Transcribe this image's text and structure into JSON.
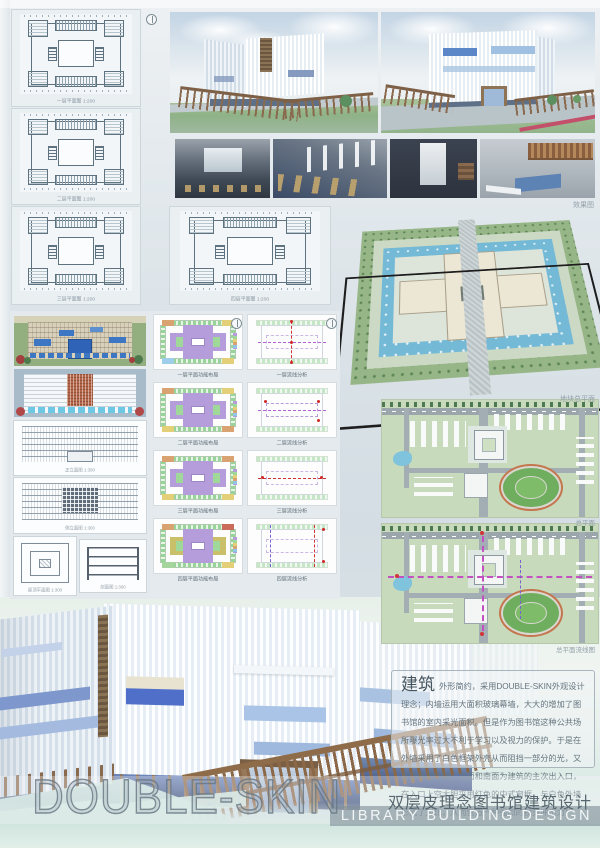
{
  "blueprints": {
    "items": [
      {
        "label": "一层平面图 1:200"
      },
      {
        "label": "二层平面图 1:200"
      },
      {
        "label": "三层平面图 1:200"
      },
      {
        "label": "四层平面图 1:200"
      }
    ]
  },
  "renders": {
    "caption": "效果图"
  },
  "site_perspective": {
    "caption": "地块总平面"
  },
  "elevations": {
    "captions": [
      "正立面图 1:300",
      "侧立面图 1:300",
      "屋顶平面图 1:300",
      "剖面图 1:300"
    ]
  },
  "plan_grid": {
    "cells": [
      {
        "label": "一层平面功能布局"
      },
      {
        "label": "一层流线分析"
      },
      {
        "label": "二层平面功能布局"
      },
      {
        "label": "二层流线分析"
      },
      {
        "label": "三层平面功能布局"
      },
      {
        "label": "三层流线分析"
      },
      {
        "label": "四层平面功能布局"
      },
      {
        "label": "四层流线分析"
      }
    ]
  },
  "site_plans": {
    "master_caption": "总平面",
    "flow_caption": "总平面流线图"
  },
  "description": {
    "title": "建筑",
    "body": "外形简约，采用DOUBLE-SKIN外观设计理念；内墙运用大面积玻璃幕墙，大大的增加了图书馆的室内采光面积。但是作为图书馆这种公共场所曝光率过大不利于学习以及视力的保护。于是在外墙采用了白色框架外壳从而阻挡一部分的光，又有装饰的作用。北面和南面为建筑的主次出入口，在入口上空大胆采用红色的中式窗框，与白色外墙形成了对比，从而营造一种强烈的视觉冲击力！"
  },
  "footer": {
    "title": "DOUBLE-SKIN",
    "subtitle_zh": "双层皮理念图书馆建筑设计",
    "subtitle_en": "LIBRARY BUILDING DESIGN"
  },
  "colors": {
    "accent_blue": "#4f6fc8",
    "wood_brown": "#97795a",
    "site_green": "#97b687",
    "water_blue": "#74b9d6"
  }
}
